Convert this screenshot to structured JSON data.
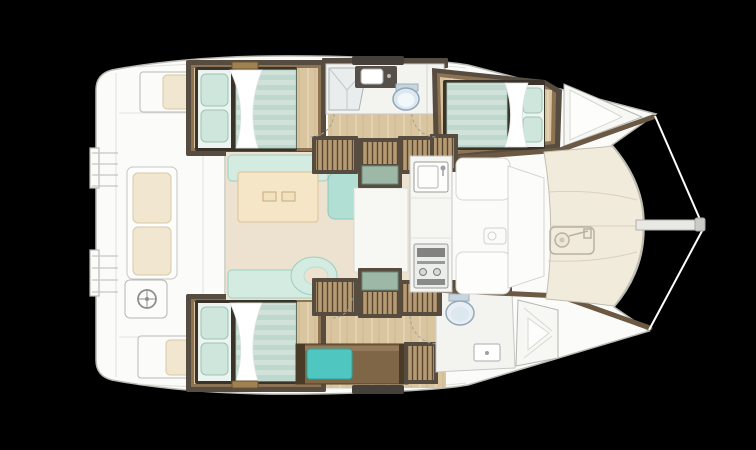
{
  "scene": {
    "type": "boat-deck-plan",
    "vessel": "sailing-catamaran",
    "view": "overhead-interior-layout",
    "orientation": "bow-right-stern-left"
  },
  "colors": {
    "background": "#000000",
    "deck": "#fbfbf9",
    "deck_stroke": "#b9b9b4",
    "deck_line": "#e0e0db",
    "foredeck": "#f1ebdc",
    "foredeck_line": "#d9d1bb",
    "saloon_floor": "#ece2cf",
    "wood_floor": "#d9c5a0",
    "wood_streak_light": "#e6d7b6",
    "wood_streak_dark": "#c9b289",
    "trim_dark": "#574c40",
    "trim_mid": "#8d7354",
    "bed_base": "#3a332a",
    "duvet_light": "#d0e2da",
    "duvet_dark": "#bed8cd",
    "pillow": "#cfe6dc",
    "sheet": "#ffffff",
    "seating": "#d4ebe2",
    "seating_dark": "#b2dfd4",
    "table": "#f5e6c8",
    "table_stroke": "#dcc193",
    "teal_cushion": "#4fc6c0",
    "steps_wood": "#b59b74",
    "steps_line": "#5a4630",
    "landing_pane": "#9db8a6",
    "bathroom_floor": "#f3f3f0",
    "toilet_fill": "#dce8f0",
    "counter_dark": "#57504a",
    "cream_cushion": "#f1e6d0",
    "cream_stroke": "#d9c8a8",
    "bench_wood": "#7e6647",
    "hull_inner_band": "#6b5944",
    "rig_line": "#ffffff"
  },
  "rooms": [
    {
      "id": "aft-port-cabin",
      "label": "double-berth-cabin"
    },
    {
      "id": "port-bathroom",
      "label": "shower-basin-toilet"
    },
    {
      "id": "forward-port-cabin",
      "label": "double-berth-cabin"
    },
    {
      "id": "aft-starboard-cabin",
      "label": "double-berth-cabin"
    },
    {
      "id": "starboard-corridor",
      "label": "hull-corridor-with-bench"
    },
    {
      "id": "forward-starboard-bathroom",
      "label": "toilet-and-basin"
    },
    {
      "id": "saloon",
      "label": "saloon-table-and-sofas"
    },
    {
      "id": "galley",
      "label": "sink-and-stove"
    },
    {
      "id": "forward-cockpit",
      "label": "forward-seating"
    },
    {
      "id": "foredeck",
      "label": "rigid-foredeck-with-windlass"
    },
    {
      "id": "aft-cockpit",
      "label": "helm-and-bench-seats"
    },
    {
      "id": "bowsprit",
      "label": "bowsprit-and-rigging"
    }
  ],
  "icons": [
    {
      "name": "windlass-icon"
    },
    {
      "name": "helm-wheel-icon"
    },
    {
      "name": "toilet-icon"
    },
    {
      "name": "shower-icon"
    },
    {
      "name": "sink-icon"
    },
    {
      "name": "stove-icon"
    },
    {
      "name": "deck-hatch-icon"
    }
  ]
}
